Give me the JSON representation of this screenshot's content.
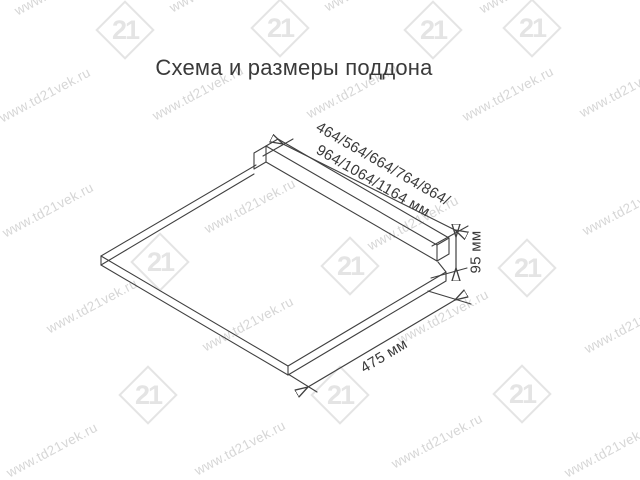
{
  "title": "Схема и размеры поддона",
  "diagram": {
    "name": "поддон (tray) isometric drawing",
    "width_dimension_line1": "464/564/664/764/864/",
    "width_dimension_line2": "964/1064/1164 мм",
    "height_dimension": "95 мм",
    "depth_dimension": "475 мм"
  },
  "watermark": {
    "text": "www.td21vek.ru",
    "logo_text": "21",
    "text_positions": [
      {
        "x": 60,
        "y": -12
      },
      {
        "x": 215,
        "y": -15
      },
      {
        "x": 370,
        "y": -16
      },
      {
        "x": 525,
        "y": -14
      },
      {
        "x": 45,
        "y": 95
      },
      {
        "x": 198,
        "y": 93
      },
      {
        "x": 352,
        "y": 91
      },
      {
        "x": 508,
        "y": 94
      },
      {
        "x": 625,
        "y": 90
      },
      {
        "x": 48,
        "y": 210
      },
      {
        "x": 250,
        "y": 206
      },
      {
        "x": 413,
        "y": 223
      },
      {
        "x": 628,
        "y": 208
      },
      {
        "x": 92,
        "y": 306
      },
      {
        "x": 248,
        "y": 324
      },
      {
        "x": 443,
        "y": 317
      },
      {
        "x": 630,
        "y": 326
      },
      {
        "x": 52,
        "y": 450
      },
      {
        "x": 240,
        "y": 448
      },
      {
        "x": 437,
        "y": 441
      },
      {
        "x": 610,
        "y": 450
      }
    ],
    "logo_positions": [
      {
        "x": 125,
        "y": 30
      },
      {
        "x": 280,
        "y": 28
      },
      {
        "x": 433,
        "y": 30
      },
      {
        "x": 532,
        "y": 28
      },
      {
        "x": 160,
        "y": 262
      },
      {
        "x": 350,
        "y": 266
      },
      {
        "x": 527,
        "y": 268
      },
      {
        "x": 148,
        "y": 395
      },
      {
        "x": 340,
        "y": 395
      },
      {
        "x": 522,
        "y": 394
      }
    ]
  },
  "colors": {
    "background": "#ffffff",
    "line": "#404040",
    "text": "#3a3a3a",
    "watermark_text": "#d6d6d6",
    "watermark_logo": "#e4e4e4"
  }
}
